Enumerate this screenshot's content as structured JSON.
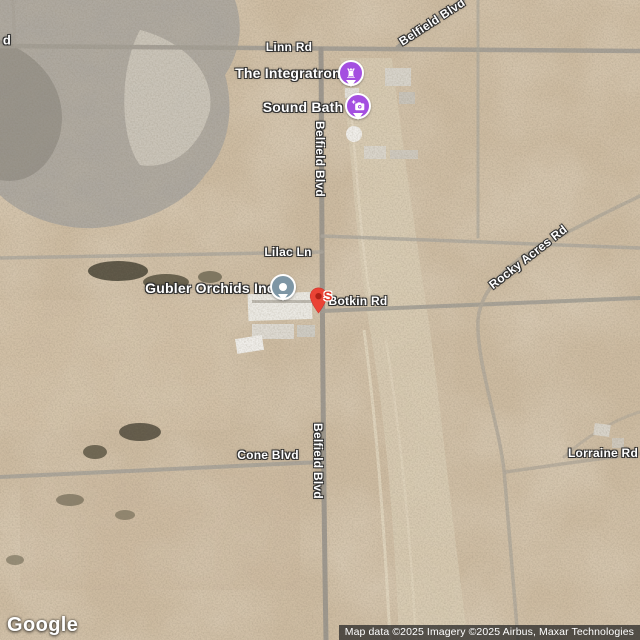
{
  "map_type": "satellite",
  "roads": {
    "linn": "Linn Rd",
    "belfield_diag": "Belfield Blvd",
    "belfield_v1": "Belfield Blvd",
    "belfield_v2": "Belfield Blvd",
    "lilac": "Lilac Ln",
    "botkin": "Botkin Rd",
    "rocky": "Rocky Acres Rd",
    "cone": "Cone Blvd",
    "lorraine": "Lorraine Rd",
    "edge_partial": "d"
  },
  "places": {
    "integratron": {
      "name": "The Integratron",
      "glyph": "♜",
      "icon": "castle-rook-icon",
      "color": "#a44fe0"
    },
    "sound_bath": {
      "name": "Sound Bath",
      "icon": "camera-plus-icon",
      "color": "#a44fe0"
    },
    "gubler": {
      "name": "Gubler Orchids Inc",
      "icon": "default-place-dot-icon",
      "color": "#7e96a5"
    }
  },
  "marker": {
    "letter": "S",
    "pin_color": "#ea4335",
    "letter_color": "#df3a2b"
  },
  "branding": {
    "logo": "Google"
  },
  "attribution": {
    "text": "Map data ©2025 Imagery ©2025 Airbus, Maxar Technologies"
  }
}
